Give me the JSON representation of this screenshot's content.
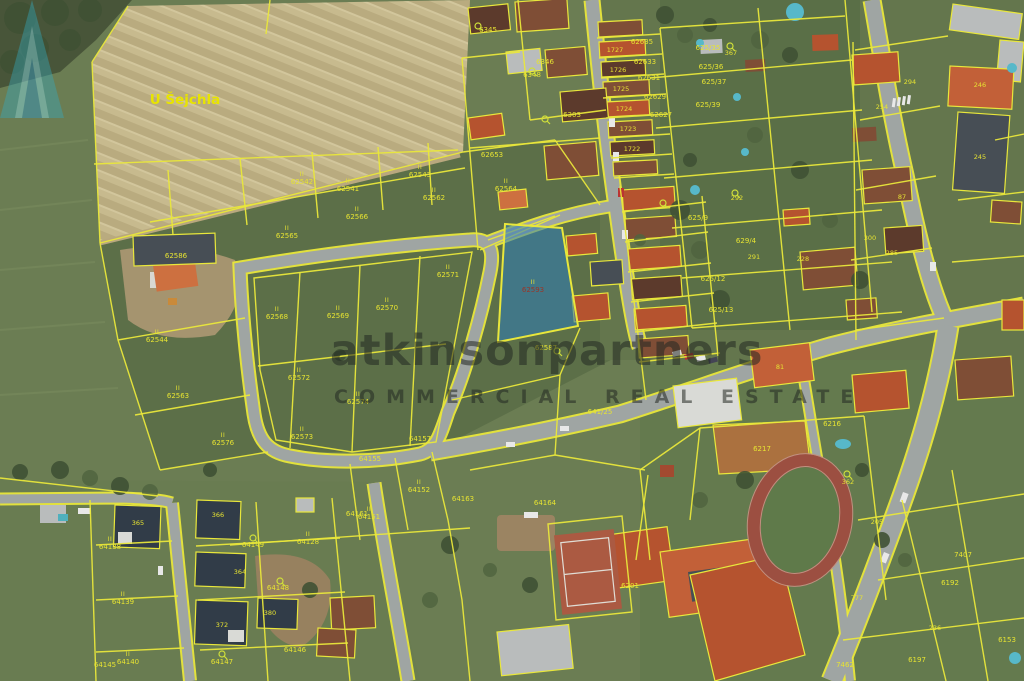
{
  "map": {
    "watermark": {
      "word1": "atkinson",
      "word2": "partners",
      "line2": "COMMERCIAL REAL ESTATE"
    },
    "colors": {
      "parcel_line": "#e9e73b",
      "label": "#e6e332",
      "road": "#9fa5a3",
      "field": "#c6b98d",
      "grass": "#6b7d53",
      "highlight_parcel": "#2f86b4",
      "logo_teal": "#3aa9bd",
      "roof_red": "#b5532f",
      "roof_dark": "#474e55",
      "track_red": "#9c4f41"
    },
    "labels": [
      {
        "x": 185,
        "y": 104,
        "text": "U Šejchla",
        "type": "place"
      },
      {
        "x": 302,
        "y": 184,
        "text": "62542",
        "mark": "II"
      },
      {
        "x": 348,
        "y": 191,
        "text": "62541",
        "mark": "II"
      },
      {
        "x": 420,
        "y": 177,
        "text": "62543",
        "mark": "II"
      },
      {
        "x": 434,
        "y": 200,
        "text": "62562",
        "mark": "II"
      },
      {
        "x": 506,
        "y": 191,
        "text": "62564",
        "mark": "II"
      },
      {
        "x": 287,
        "y": 238,
        "text": "62565",
        "mark": "II"
      },
      {
        "x": 357,
        "y": 219,
        "text": "62566",
        "mark": "II"
      },
      {
        "x": 277,
        "y": 319,
        "text": "62568",
        "mark": "II"
      },
      {
        "x": 338,
        "y": 318,
        "text": "62569",
        "mark": "II"
      },
      {
        "x": 387,
        "y": 310,
        "text": "62570",
        "mark": "II"
      },
      {
        "x": 448,
        "y": 277,
        "text": "62571",
        "mark": "II"
      },
      {
        "x": 299,
        "y": 380,
        "text": "62572",
        "mark": "II"
      },
      {
        "x": 302,
        "y": 439,
        "text": "62573",
        "mark": "II"
      },
      {
        "x": 358,
        "y": 404,
        "text": "62574",
        "mark": "II"
      },
      {
        "x": 178,
        "y": 398,
        "text": "62563",
        "mark": "II"
      },
      {
        "x": 223,
        "y": 445,
        "text": "62576",
        "mark": "II"
      },
      {
        "x": 157,
        "y": 342,
        "text": "62544",
        "mark": "II"
      },
      {
        "x": 176,
        "y": 258,
        "text": "62586"
      },
      {
        "x": 533,
        "y": 292,
        "text": "62593",
        "type": "red",
        "mark": "II"
      },
      {
        "x": 546,
        "y": 350,
        "text": "62587"
      },
      {
        "x": 370,
        "y": 461,
        "text": "64155"
      },
      {
        "x": 369,
        "y": 519,
        "text": "64151",
        "mark": "II"
      },
      {
        "x": 419,
        "y": 492,
        "text": "64152",
        "mark": "II"
      },
      {
        "x": 357,
        "y": 516,
        "text": "64161"
      },
      {
        "x": 463,
        "y": 501,
        "text": "64163"
      },
      {
        "x": 545,
        "y": 505,
        "text": "64164"
      },
      {
        "x": 420,
        "y": 441,
        "text": "64157"
      },
      {
        "x": 600,
        "y": 414,
        "text": "641/25"
      },
      {
        "x": 123,
        "y": 604,
        "text": "64139",
        "mark": "II"
      },
      {
        "x": 110,
        "y": 549,
        "text": "64138",
        "mark": "II"
      },
      {
        "x": 128,
        "y": 664,
        "text": "64140",
        "mark": "II"
      },
      {
        "x": 105,
        "y": 667,
        "text": "64145"
      },
      {
        "x": 253,
        "y": 547,
        "text": "64149"
      },
      {
        "x": 278,
        "y": 590,
        "text": "64148"
      },
      {
        "x": 222,
        "y": 664,
        "text": "64147"
      },
      {
        "x": 295,
        "y": 652,
        "text": "64146"
      },
      {
        "x": 308,
        "y": 544,
        "text": "64128",
        "mark": "II"
      },
      {
        "x": 138,
        "y": 525,
        "text": "365",
        "type": "house"
      },
      {
        "x": 218,
        "y": 517,
        "text": "366",
        "type": "house"
      },
      {
        "x": 240,
        "y": 574,
        "text": "364",
        "type": "house"
      },
      {
        "x": 222,
        "y": 627,
        "text": "372",
        "type": "house"
      },
      {
        "x": 270,
        "y": 615,
        "text": "380",
        "type": "house"
      },
      {
        "x": 488,
        "y": 32,
        "text": "6345"
      },
      {
        "x": 532,
        "y": 77,
        "text": "6348"
      },
      {
        "x": 545,
        "y": 64,
        "text": "6346"
      },
      {
        "x": 572,
        "y": 117,
        "text": "6303"
      },
      {
        "x": 492,
        "y": 157,
        "text": "62653"
      },
      {
        "x": 642,
        "y": 44,
        "text": "62635"
      },
      {
        "x": 645,
        "y": 64,
        "text": "62633"
      },
      {
        "x": 649,
        "y": 80,
        "text": "62631"
      },
      {
        "x": 655,
        "y": 99,
        "text": "62629"
      },
      {
        "x": 661,
        "y": 117,
        "text": "62627"
      },
      {
        "x": 708,
        "y": 50,
        "text": "625/35"
      },
      {
        "x": 711,
        "y": 69,
        "text": "625/36"
      },
      {
        "x": 714,
        "y": 84,
        "text": "625/37"
      },
      {
        "x": 708,
        "y": 107,
        "text": "625/39"
      },
      {
        "x": 731,
        "y": 55,
        "text": "367",
        "type": "house"
      },
      {
        "x": 615,
        "y": 52,
        "text": "1727",
        "type": "house"
      },
      {
        "x": 618,
        "y": 72,
        "text": "1726",
        "type": "house"
      },
      {
        "x": 621,
        "y": 91,
        "text": "1725",
        "type": "house"
      },
      {
        "x": 624,
        "y": 111,
        "text": "1724",
        "type": "house"
      },
      {
        "x": 628,
        "y": 131,
        "text": "1723",
        "type": "house"
      },
      {
        "x": 632,
        "y": 151,
        "text": "1722",
        "type": "house"
      },
      {
        "x": 746,
        "y": 243,
        "text": "629/4"
      },
      {
        "x": 737,
        "y": 200,
        "text": "292",
        "type": "house"
      },
      {
        "x": 754,
        "y": 259,
        "text": "291",
        "type": "house"
      },
      {
        "x": 803,
        "y": 261,
        "text": "228",
        "type": "house"
      },
      {
        "x": 698,
        "y": 220,
        "text": "625/9"
      },
      {
        "x": 713,
        "y": 281,
        "text": "625/12"
      },
      {
        "x": 721,
        "y": 312,
        "text": "625/13"
      },
      {
        "x": 910,
        "y": 84,
        "text": "294",
        "type": "house"
      },
      {
        "x": 980,
        "y": 87,
        "text": "246",
        "type": "house"
      },
      {
        "x": 980,
        "y": 159,
        "text": "245",
        "type": "house"
      },
      {
        "x": 882,
        "y": 109,
        "text": "254",
        "type": "house"
      },
      {
        "x": 902,
        "y": 199,
        "text": "87",
        "type": "house"
      },
      {
        "x": 870,
        "y": 240,
        "text": "300",
        "type": "house"
      },
      {
        "x": 892,
        "y": 255,
        "text": "285",
        "type": "house"
      },
      {
        "x": 762,
        "y": 451,
        "text": "6217"
      },
      {
        "x": 832,
        "y": 426,
        "text": "6216"
      },
      {
        "x": 848,
        "y": 484,
        "text": "362",
        "type": "house"
      },
      {
        "x": 630,
        "y": 588,
        "text": "6201"
      },
      {
        "x": 877,
        "y": 524,
        "text": "205",
        "type": "house"
      },
      {
        "x": 780,
        "y": 369,
        "text": "81",
        "type": "house"
      },
      {
        "x": 963,
        "y": 557,
        "text": "7407"
      },
      {
        "x": 950,
        "y": 585,
        "text": "6192"
      },
      {
        "x": 857,
        "y": 600,
        "text": "777",
        "type": "house"
      },
      {
        "x": 935,
        "y": 630,
        "text": "236",
        "type": "house"
      },
      {
        "x": 917,
        "y": 662,
        "text": "6197"
      },
      {
        "x": 1007,
        "y": 642,
        "text": "6153"
      },
      {
        "x": 845,
        "y": 667,
        "text": "7462"
      },
      {
        "x": 557,
        "y": 351,
        "type": "symbol"
      },
      {
        "x": 478,
        "y": 26,
        "type": "symbol"
      },
      {
        "x": 532,
        "y": 71,
        "type": "symbol"
      },
      {
        "x": 545,
        "y": 119,
        "type": "symbol"
      },
      {
        "x": 847,
        "y": 474,
        "type": "symbol"
      },
      {
        "x": 735,
        "y": 193,
        "type": "symbol"
      },
      {
        "x": 253,
        "y": 538,
        "type": "symbol"
      },
      {
        "x": 280,
        "y": 581,
        "type": "symbol"
      },
      {
        "x": 222,
        "y": 654,
        "type": "symbol"
      },
      {
        "x": 730,
        "y": 46,
        "type": "symbol"
      },
      {
        "x": 663,
        "y": 203,
        "type": "symbol"
      }
    ]
  }
}
